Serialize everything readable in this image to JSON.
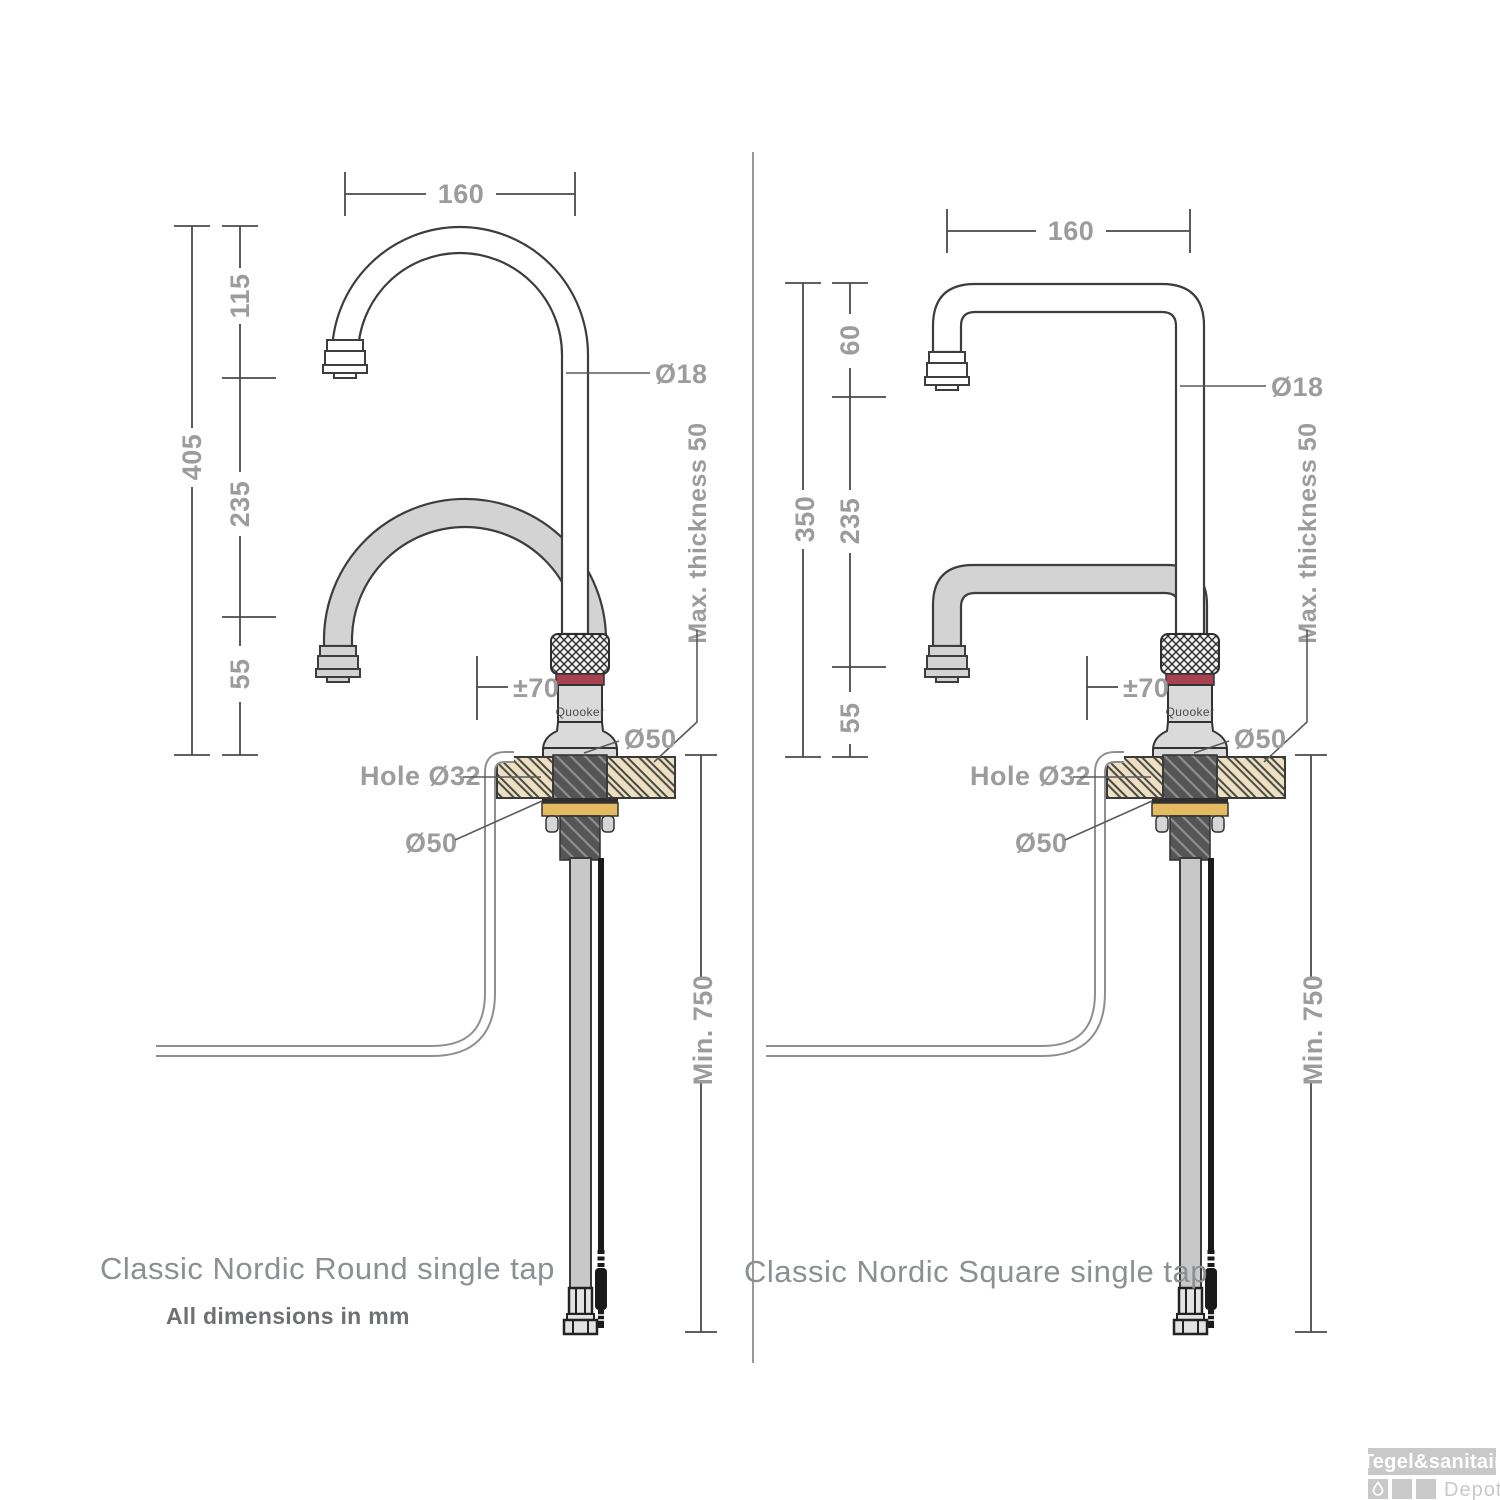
{
  "left": {
    "caption": "Classic Nordic Round single tap",
    "note": "All dimensions in mm",
    "brand": "Quooker",
    "dims": {
      "top_width": "160",
      "upper": "115",
      "overall": "405",
      "middle": "235",
      "lower": "55",
      "spout_diameter": "Ø18",
      "max_thickness": "Max. thickness 50",
      "swivel": "±70",
      "base_diameter": "Ø50",
      "hole_diameter": "Hole Ø32",
      "washer_diameter": "Ø50",
      "min_depth": "Min. 750"
    }
  },
  "right": {
    "caption": "Classic Nordic Square single tap",
    "brand": "Quooker",
    "dims": {
      "top_width": "160",
      "upper": "60",
      "overall": "350",
      "middle": "235",
      "lower": "55",
      "spout_diameter": "Ø18",
      "max_thickness": "Max. thickness 50",
      "swivel": "±70",
      "base_diameter": "Ø50",
      "hole_diameter": "Hole Ø32",
      "washer_diameter": "Ø50",
      "min_depth": "Min. 750"
    }
  },
  "watermark": {
    "line1": "Tegel&sanitair",
    "line2": "Depot"
  },
  "colors": {
    "red_ring": "#a84250",
    "brass_washer": "#e4ba62",
    "counter_wood": "#ecdfc2",
    "spout_gray": "#d3d3d3",
    "dim_text": "#9c9c9c"
  }
}
